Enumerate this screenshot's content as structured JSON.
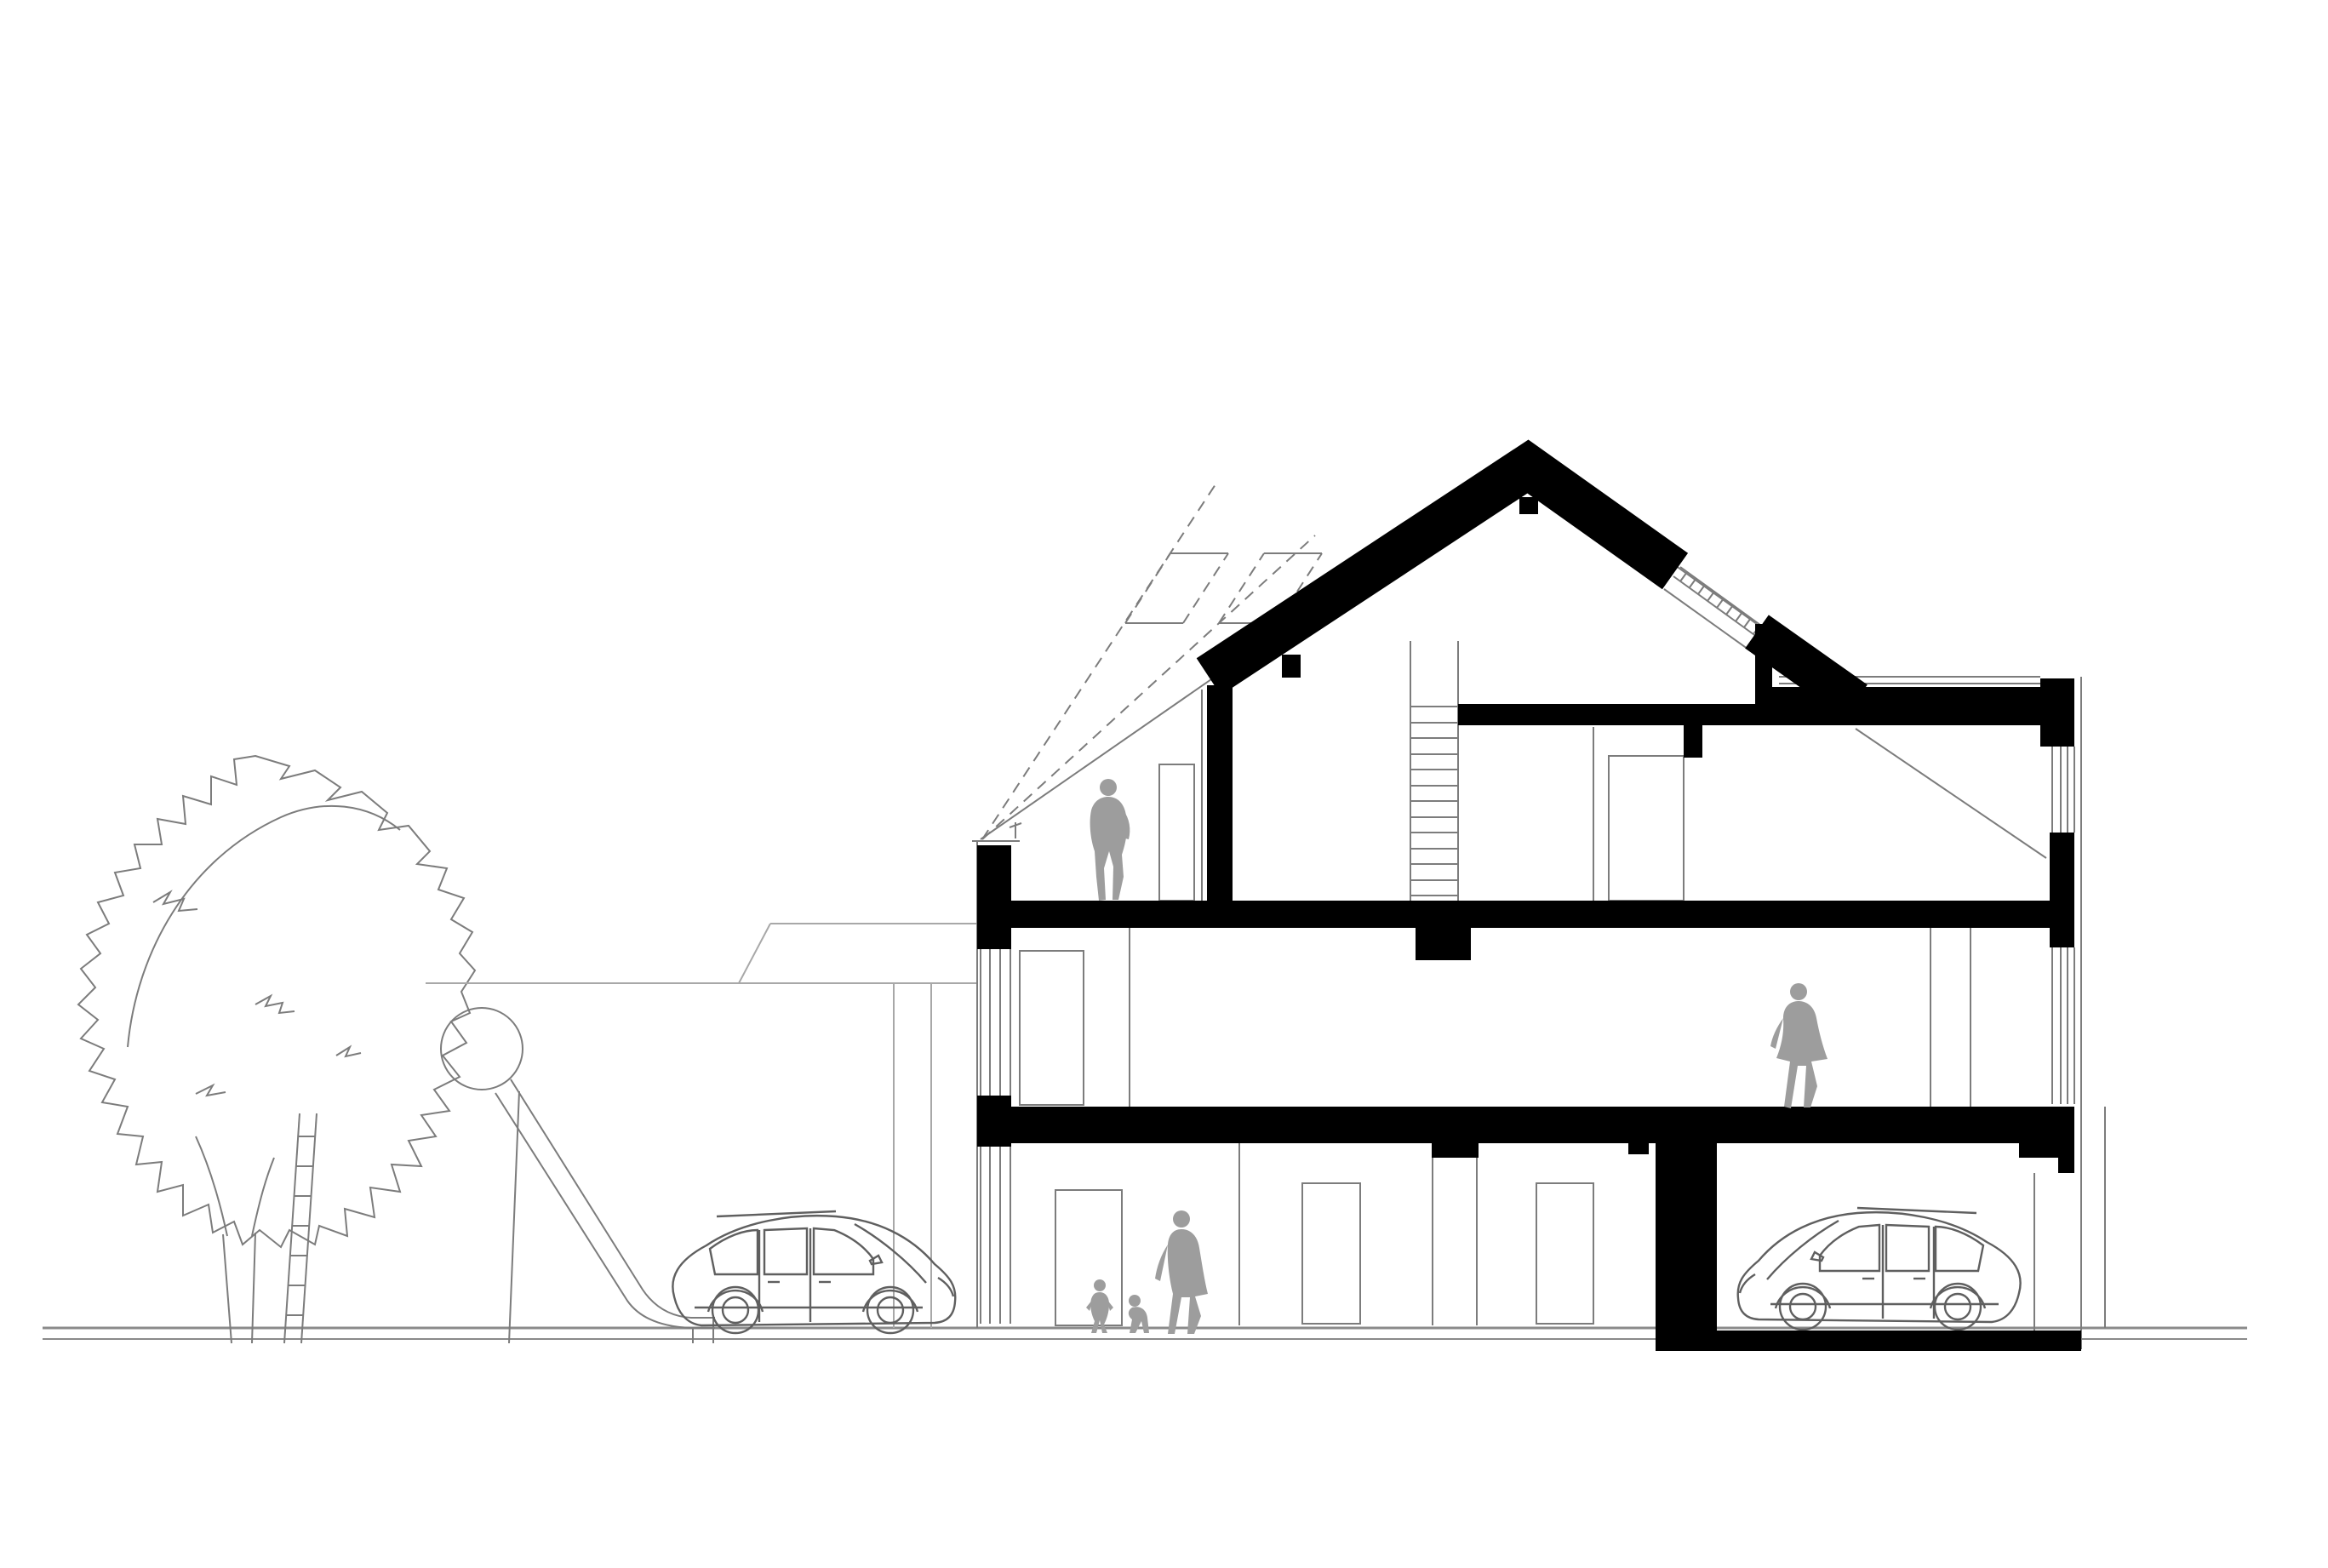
{
  "scene": {
    "kind": "architectural-cross-section-drawing",
    "description": "Black and white sectional drawing of a three-level gabled house with flat-roof terrace, roof ladder, garage with parked car, interior figures, and outside a large tree with a playground slide and a second parked car",
    "background": "#ffffff"
  },
  "colors": {
    "cut_black": "#000000",
    "line_gray": "#7c7c7c",
    "light_gray": "#a8a8a8",
    "ground_gray": "#8a8a8a",
    "figure_gray": "#9d9d9d",
    "car_gray": "#5f5f5f"
  },
  "inventory": {
    "building": {
      "levels": [
        "ground-floor",
        "upper-floor",
        "attic"
      ],
      "roof": "gable-roof-with-flat-roof-section",
      "skylights": 2,
      "roof_ladder_rungs": 13,
      "garage_cars": 1
    },
    "figures": [
      {
        "name": "man-in-attic"
      },
      {
        "name": "woman-on-upper-floor"
      },
      {
        "name": "child-walking"
      },
      {
        "name": "toddler"
      },
      {
        "name": "adult-with-children"
      }
    ],
    "site": [
      {
        "name": "tree"
      },
      {
        "name": "playground-slide"
      },
      {
        "name": "parked-car-outside"
      },
      {
        "name": "background-annex"
      }
    ]
  }
}
